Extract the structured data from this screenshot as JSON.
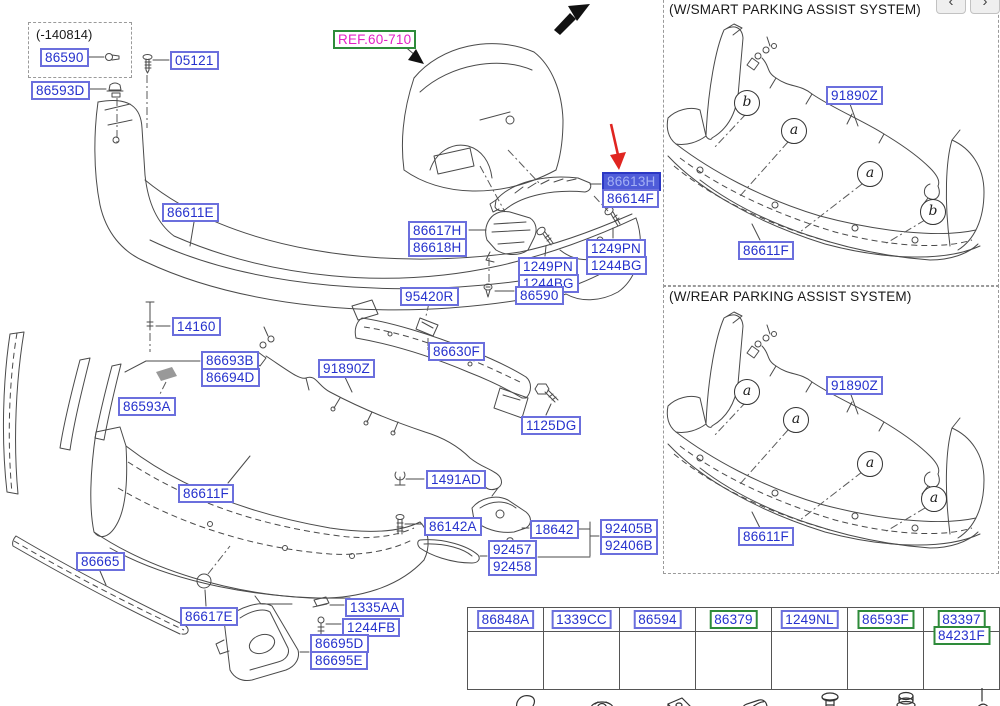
{
  "fr_marker": "FR.",
  "nav_buttons": {
    "prev": "‹",
    "next": "›"
  },
  "note_box": {
    "text": "(-140814)"
  },
  "panels": [
    {
      "title": "(W/SMART PARKING ASSIST SYSTEM)"
    },
    {
      "title": "(W/REAR PARKING ASSIST SYSTEM)"
    }
  ],
  "highlighted_part": "86613H",
  "colors": {
    "label_text": "#2531cd",
    "label_border": "#6b6fdd",
    "highlight_bg": "#4f5cd9",
    "green_border": "#2e8b3a",
    "ref_text": "#e41fc6",
    "arrow_red": "#e02520",
    "line_art": "#4a4a4a"
  },
  "part_labels": [
    {
      "text": "86590",
      "x": 40,
      "y": 48,
      "style": "blue"
    },
    {
      "text": "05121",
      "x": 170,
      "y": 51,
      "style": "blue"
    },
    {
      "text": "86593D",
      "x": 31,
      "y": 81,
      "style": "blue"
    },
    {
      "text": "REF.60-710",
      "x": 333,
      "y": 30,
      "style": "ref"
    },
    {
      "text": "86611E",
      "x": 162,
      "y": 203,
      "style": "blue"
    },
    {
      "text": "86613H",
      "x": 602,
      "y": 172,
      "style": "hl"
    },
    {
      "text": "86614F",
      "x": 602,
      "y": 189,
      "style": "blue"
    },
    {
      "text": "86617H",
      "x": 408,
      "y": 221,
      "style": "blue"
    },
    {
      "text": "86618H",
      "x": 408,
      "y": 238,
      "style": "blue"
    },
    {
      "text": "1249PN",
      "x": 518,
      "y": 257,
      "style": "blue"
    },
    {
      "text": "1244BG",
      "x": 518,
      "y": 274,
      "style": "blue"
    },
    {
      "text": "1249PN",
      "x": 586,
      "y": 239,
      "style": "blue"
    },
    {
      "text": "1244BG",
      "x": 586,
      "y": 256,
      "style": "blue"
    },
    {
      "text": "95420R",
      "x": 400,
      "y": 287,
      "style": "blue"
    },
    {
      "text": "86590",
      "x": 515,
      "y": 286,
      "style": "blue"
    },
    {
      "text": "14160",
      "x": 172,
      "y": 317,
      "style": "blue"
    },
    {
      "text": "86693B",
      "x": 201,
      "y": 351,
      "style": "blue"
    },
    {
      "text": "86694D",
      "x": 201,
      "y": 368,
      "style": "blue"
    },
    {
      "text": "86593A",
      "x": 118,
      "y": 397,
      "style": "blue"
    },
    {
      "text": "91890Z",
      "x": 318,
      "y": 359,
      "style": "blue"
    },
    {
      "text": "86630F",
      "x": 428,
      "y": 342,
      "style": "blue"
    },
    {
      "text": "1125DG",
      "x": 521,
      "y": 416,
      "style": "blue"
    },
    {
      "text": "1491AD",
      "x": 426,
      "y": 470,
      "style": "blue"
    },
    {
      "text": "86611F",
      "x": 178,
      "y": 484,
      "style": "blue"
    },
    {
      "text": "86142A",
      "x": 424,
      "y": 517,
      "style": "blue"
    },
    {
      "text": "18642",
      "x": 530,
      "y": 520,
      "style": "blue"
    },
    {
      "text": "92405B",
      "x": 600,
      "y": 519,
      "style": "blue"
    },
    {
      "text": "92406B",
      "x": 600,
      "y": 536,
      "style": "blue"
    },
    {
      "text": "92457",
      "x": 488,
      "y": 540,
      "style": "blue"
    },
    {
      "text": "92458",
      "x": 488,
      "y": 557,
      "style": "blue"
    },
    {
      "text": "86665",
      "x": 76,
      "y": 552,
      "style": "blue"
    },
    {
      "text": "86617E",
      "x": 180,
      "y": 607,
      "style": "blue"
    },
    {
      "text": "1335AA",
      "x": 345,
      "y": 598,
      "style": "blue"
    },
    {
      "text": "1244FB",
      "x": 342,
      "y": 618,
      "style": "blue"
    },
    {
      "text": "86695D",
      "x": 310,
      "y": 634,
      "style": "blue"
    },
    {
      "text": "86695E",
      "x": 310,
      "y": 651,
      "style": "blue"
    },
    {
      "text": "91890Z",
      "x": 826,
      "y": 86,
      "style": "blue"
    },
    {
      "text": "86611F",
      "x": 738,
      "y": 241,
      "style": "blue"
    },
    {
      "text": "91890Z",
      "x": 826,
      "y": 376,
      "style": "blue"
    },
    {
      "text": "86611F",
      "x": 738,
      "y": 527,
      "style": "blue"
    }
  ],
  "callouts": [
    {
      "letter": "b",
      "x": 746,
      "y": 102
    },
    {
      "letter": "a",
      "x": 793,
      "y": 130
    },
    {
      "letter": "a",
      "x": 869,
      "y": 173
    },
    {
      "letter": "b",
      "x": 932,
      "y": 211
    },
    {
      "letter": "a",
      "x": 746,
      "y": 391
    },
    {
      "letter": "a",
      "x": 795,
      "y": 419
    },
    {
      "letter": "a",
      "x": 869,
      "y": 463
    },
    {
      "letter": "a",
      "x": 933,
      "y": 498
    }
  ],
  "fastener_table": {
    "columns": [
      {
        "parts": [
          "86848A"
        ],
        "style": "blue",
        "icon": "clip-icon"
      },
      {
        "parts": [
          "1339CC"
        ],
        "style": "blue",
        "icon": "nut-icon"
      },
      {
        "parts": [
          "86594"
        ],
        "style": "blue",
        "icon": "grommet-icon"
      },
      {
        "parts": [
          "86379"
        ],
        "style": "green",
        "icon": "pad-icon"
      },
      {
        "parts": [
          "1249NL"
        ],
        "style": "blue",
        "icon": "screw-icon"
      },
      {
        "parts": [
          "86593F"
        ],
        "style": "green",
        "icon": "bolt-icon"
      },
      {
        "parts": [
          "83397",
          "84231F"
        ],
        "style": "green",
        "icon": "plug-icon"
      }
    ]
  }
}
